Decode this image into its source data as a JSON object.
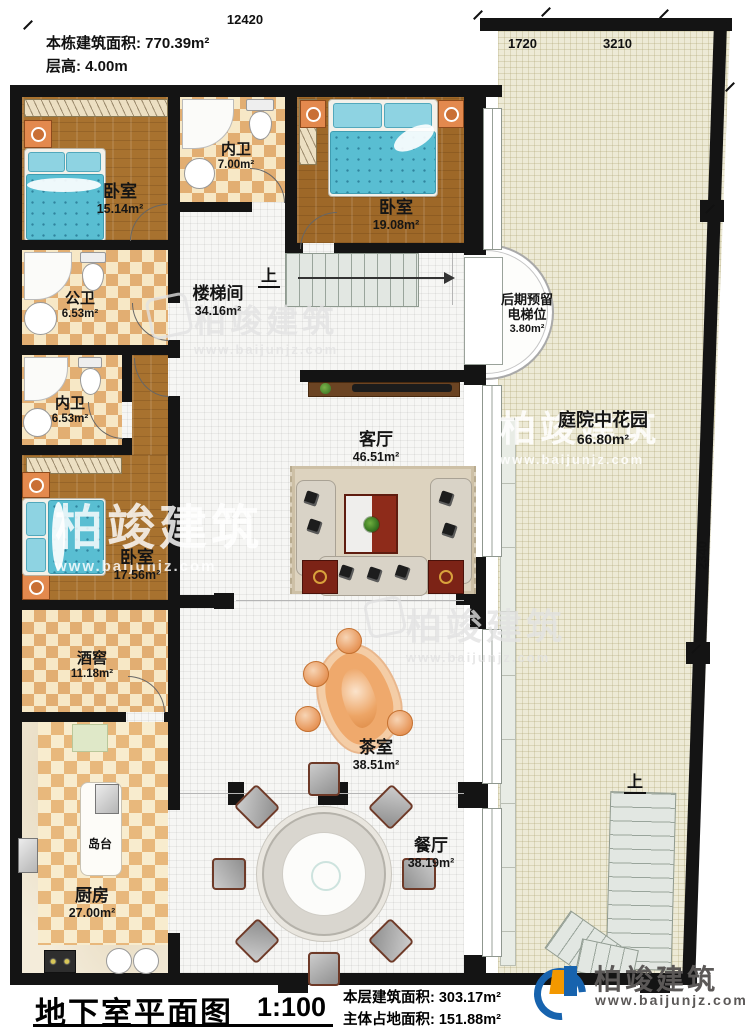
{
  "meta": {
    "building_area": "本栋建筑面积: 770.39m²",
    "floor_height": "层高: 4.00m"
  },
  "dims": {
    "top": "12420",
    "garden_left": "1720",
    "garden_right": "3210",
    "right": "2340"
  },
  "rooms": {
    "bedroom1": {
      "name": "卧室",
      "area": "15.14m²"
    },
    "bath1": {
      "name": "内卫",
      "area": "7.00m²"
    },
    "bedroom2": {
      "name": "卧室",
      "area": "19.08m²"
    },
    "pubbath": {
      "name": "公卫",
      "area": "6.53m²"
    },
    "stairhall": {
      "name": "楼梯间",
      "area": "34.16m²"
    },
    "bath2": {
      "name": "内卫",
      "area": "6.53m²"
    },
    "bedroom3": {
      "name": "卧室",
      "area": "17.56m²"
    },
    "wine": {
      "name": "酒窖",
      "area": "11.18m²"
    },
    "kitchen": {
      "name": "厨房",
      "area": "27.00m²"
    },
    "island": {
      "name": "岛台"
    },
    "living": {
      "name": "客厅",
      "area": "46.51m²"
    },
    "tea": {
      "name": "茶室",
      "area": "38.51m²"
    },
    "dining": {
      "name": "餐厅",
      "area": "38.19m²"
    },
    "garden": {
      "name": "庭院中花园",
      "area": "66.80m²"
    },
    "elevator": {
      "line1": "后期预留",
      "line2": "电梯位",
      "area": "3.80m²"
    }
  },
  "stairs": {
    "up": "上"
  },
  "footer": {
    "title": "地下室平面图",
    "scale": "1:100",
    "floor_area": "本层建筑面积: 303.17m²",
    "footprint_area": "主体占地面积: 151.88m²"
  },
  "brand": {
    "name": "柏竣建筑",
    "url": "www.baijunjz.com"
  }
}
